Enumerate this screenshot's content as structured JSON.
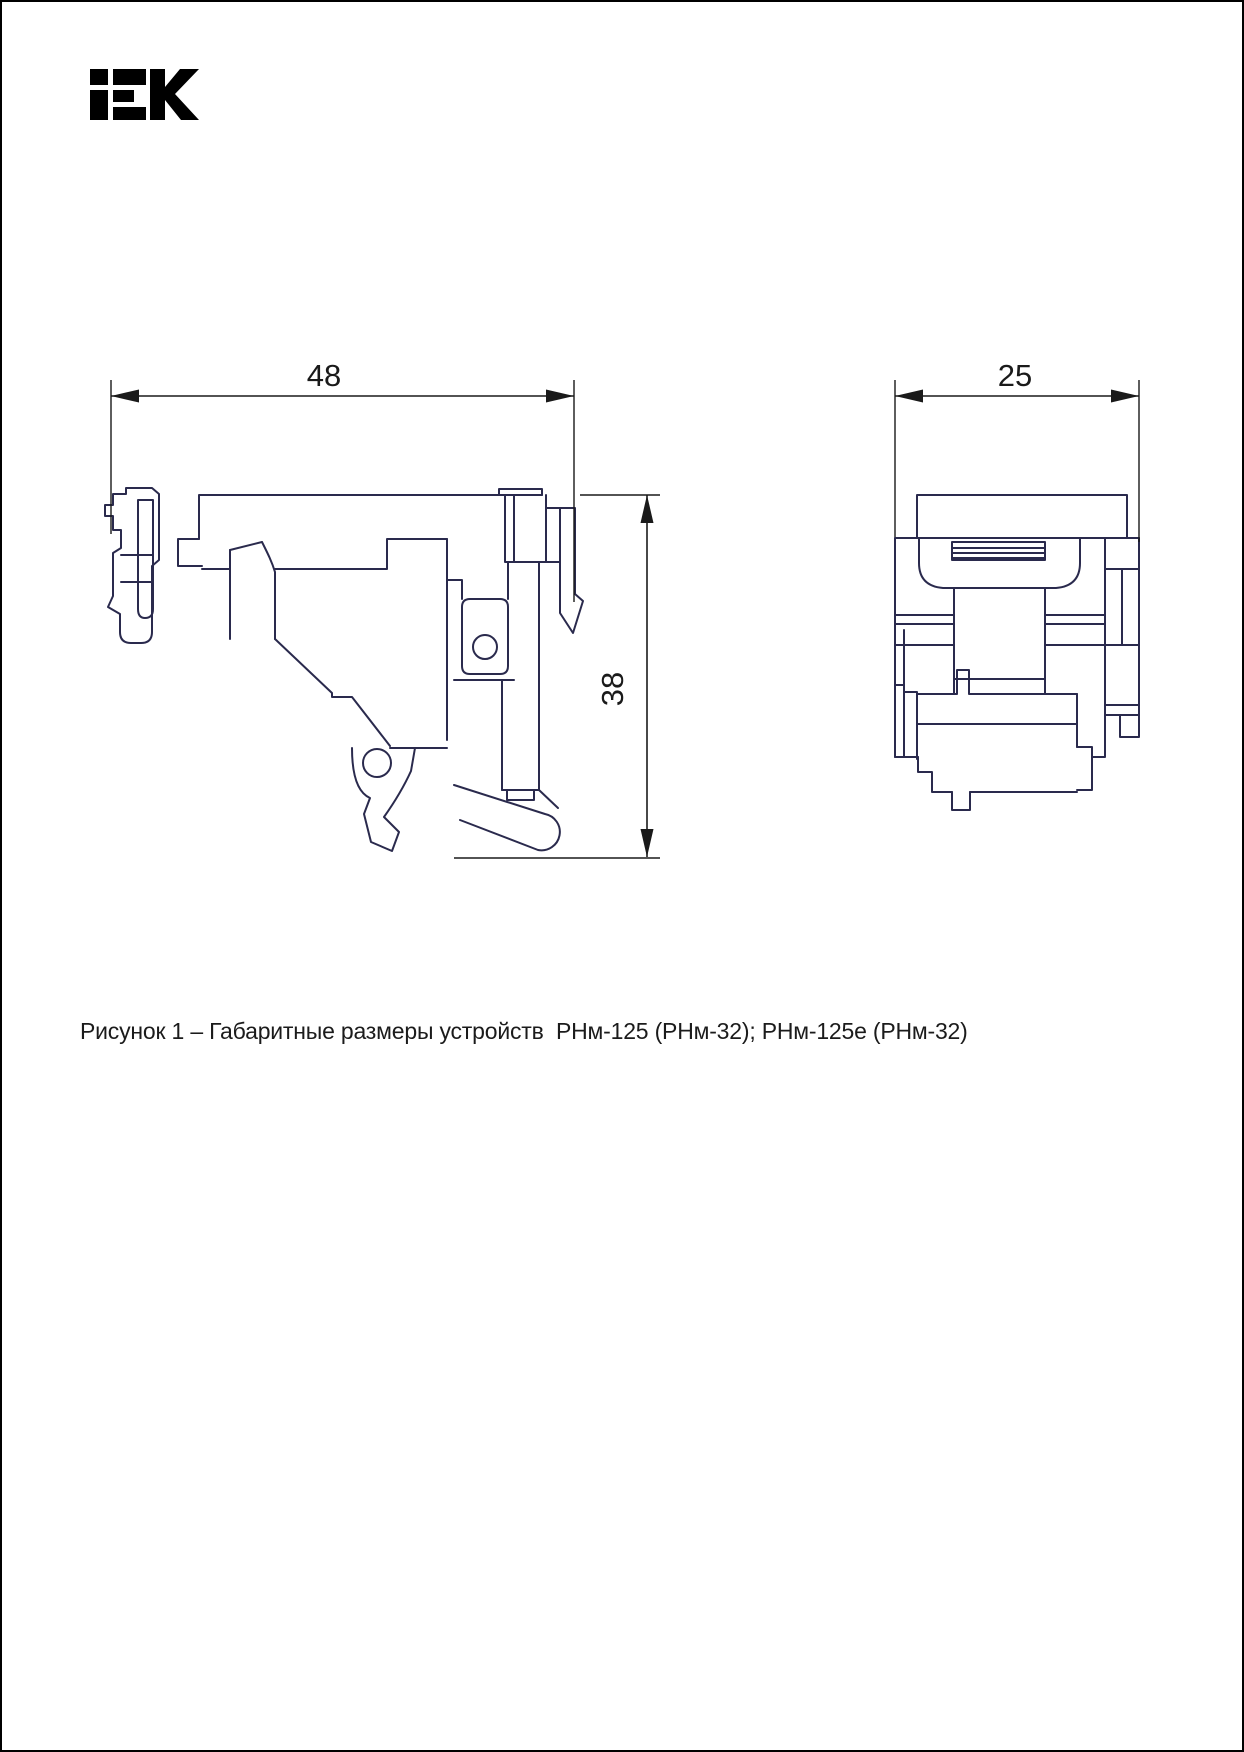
{
  "page": {
    "background_color": "#ffffff",
    "frame_color": "#000000"
  },
  "header": {
    "logo": {
      "brand": "iEK",
      "color": "#000000"
    }
  },
  "figure": {
    "line_color": "#2a2a4d",
    "dim_color": "#1a1a1a",
    "views": {
      "side_view": {
        "name": "side view",
        "width_mm": "48",
        "height_mm": "38"
      },
      "front_view": {
        "name": "front view",
        "width_mm": "25"
      }
    },
    "caption": "Рисунок 1 – Габаритные размеры устройств  РНм-125 (РНм-32); РНм-125е (РНм-32)"
  }
}
